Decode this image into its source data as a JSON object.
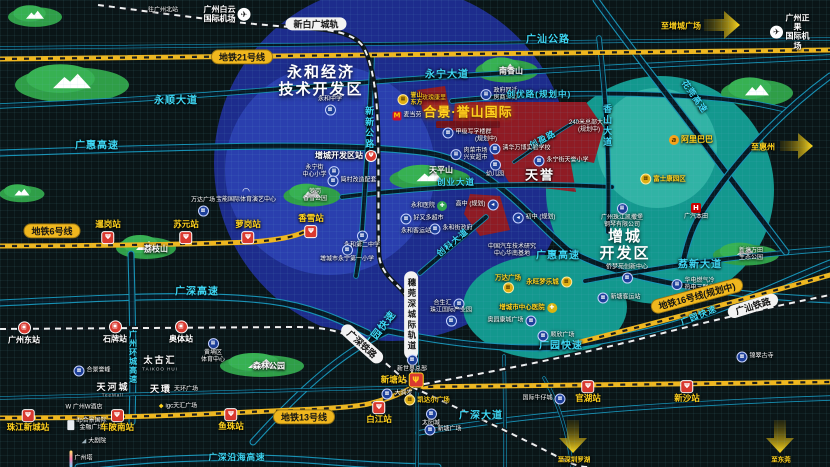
{
  "map": {
    "width": 830,
    "height": 467,
    "colors": {
      "bg": "#0a1517",
      "blue": "#1d2c8c",
      "blueInner": "#2a3fae",
      "teal": "#13988e",
      "tealInner": "#31b3a5",
      "red": "#8f1b24",
      "park": "#2f9e47",
      "gold": "#ffd21e",
      "cyan": "#3fd9f6",
      "yline": "#f0b71e"
    },
    "labels": [
      {
        "name": "to-gz-north",
        "text": "往广州北站",
        "x": 163,
        "y": 11,
        "cls": "tiny"
      },
      {
        "name": "baiyun-airport",
        "text": "广州白云\n国际机场",
        "x": 227,
        "y": 14,
        "cls": "white8",
        "ic": "plane",
        "side": "r"
      },
      {
        "name": "xinbaiguang-pill",
        "text": "新白广城轨",
        "x": 316,
        "y": 24,
        "cls": "pill-w"
      },
      {
        "name": "m21-pill",
        "text": "地铁21号线",
        "x": 242,
        "y": 57,
        "cls": "pill-y"
      },
      {
        "name": "guangshan-highway",
        "text": "广汕公路",
        "x": 548,
        "y": 40,
        "cls": "road"
      },
      {
        "name": "to-zengcheng-square",
        "text": "至增城广场",
        "x": 681,
        "y": 26,
        "cls": "gold8"
      },
      {
        "name": "zhengguo-airport",
        "text": "广州正果\n国际机场",
        "x": 790,
        "y": 32,
        "cls": "white8",
        "ic": "plane",
        "side": "l"
      },
      {
        "name": "yonghe-zone-title",
        "text": "永和经济\n技术开发区",
        "x": 321,
        "y": 81,
        "cls": "zone"
      },
      {
        "name": "yongshun-avenue",
        "text": "永顺大道",
        "x": 176,
        "y": 101,
        "cls": "road"
      },
      {
        "name": "guanghui-expressway",
        "text": "广惠高速",
        "x": 97,
        "y": 146,
        "cls": "road"
      },
      {
        "name": "yongning-avenue",
        "text": "永宁大道",
        "x": 447,
        "y": 75,
        "cls": "road"
      },
      {
        "name": "nanxiang-mountain",
        "text": "南香山",
        "x": 511,
        "y": 71,
        "cls": "poi7"
      },
      {
        "name": "yushan-dongfang",
        "text": "誉山\n东方",
        "x": 410,
        "y": 100,
        "cls": "proj-sm",
        "ic": "bldg",
        "side": "l"
      },
      {
        "name": "kangli-plot",
        "text": "玫瑰康里",
        "x": 434,
        "y": 99,
        "cls": "red-sm"
      },
      {
        "name": "govt-resettle-street",
        "text": "政府回迁\n房商业街",
        "x": 499,
        "y": 95,
        "cls": "tiny",
        "ic": "bld",
        "side": "l"
      },
      {
        "name": "chuangyou-road",
        "text": "创优路(规划中)",
        "x": 539,
        "y": 95,
        "cls": "road-sm"
      },
      {
        "name": "mcdonalds",
        "text": "麦当劳",
        "x": 407,
        "y": 116,
        "cls": "tiny",
        "ic": "mcd",
        "side": "l"
      },
      {
        "name": "yushan-international-title",
        "text": "合景·誉山国际",
        "x": 468,
        "y": 113,
        "cls": "proj"
      },
      {
        "name": "grade-a-offices",
        "text": "甲级写字楼群",
        "x": 467,
        "y": 133,
        "cls": "tiny",
        "ic": "bld",
        "side": "l"
      },
      {
        "name": "offices-planned",
        "text": "(规划中)",
        "x": 486,
        "y": 140,
        "cls": "tiny"
      },
      {
        "name": "hq-tower-240m",
        "text": "240米总部大楼\n(规划中)",
        "x": 589,
        "y": 127,
        "cls": "tiny"
      },
      {
        "name": "chuangying-road",
        "text": "创盈路",
        "x": 543,
        "y": 140,
        "cls": "road-sm",
        "rot": -28
      },
      {
        "name": "xiangshan-avenue",
        "text": "香山大道",
        "x": 607,
        "y": 126,
        "cls": "road-v"
      },
      {
        "name": "alibaba",
        "text": "阿里巴巴",
        "x": 691,
        "y": 140,
        "cls": "gold8",
        "ic": "ali",
        "side": "l"
      },
      {
        "name": "to-huizhou",
        "text": "至惠州",
        "x": 763,
        "y": 147,
        "cls": "gold8"
      },
      {
        "name": "foxconn-park",
        "text": "富士康园区",
        "x": 663,
        "y": 179,
        "cls": "gold",
        "ic": "bldg",
        "side": "l"
      },
      {
        "name": "huaguan-expressway",
        "text": "花莞高速",
        "x": 694,
        "y": 97,
        "cls": "road-sm",
        "rot": 55
      },
      {
        "name": "zengcheng-devzone-station",
        "text": "增城开发区站",
        "x": 346,
        "y": 156,
        "cls": "white8",
        "ic": "mround",
        "side": "r"
      },
      {
        "name": "yongning-central-primary",
        "text": "永宁街\n中心小学",
        "x": 321,
        "y": 172,
        "cls": "tiny",
        "ic": "bld",
        "side": "r"
      },
      {
        "name": "jiancun-renewal",
        "text": "简村改造配套",
        "x": 352,
        "y": 181,
        "cls": "tiny",
        "ic": "bld",
        "side": "l"
      },
      {
        "name": "luogang-xiangxue-park",
        "text": "萝岗\n香雪公园",
        "x": 315,
        "y": 196,
        "cls": "tiny"
      },
      {
        "name": "baoneng-arena",
        "text": "宝能国际体育演艺中心",
        "x": 246,
        "y": 196,
        "cls": "tiny",
        "ic": "dome",
        "side": "t"
      },
      {
        "name": "wanda-plaza-suyuan",
        "text": "万达广场",
        "x": 203,
        "y": 207,
        "cls": "tiny",
        "ic": "bld",
        "side": "b"
      },
      {
        "name": "tianping-mountain",
        "text": "天平山",
        "x": 441,
        "y": 170,
        "cls": "poi7"
      },
      {
        "name": "chuangye-avenue",
        "text": "创业大道",
        "x": 456,
        "y": 183,
        "cls": "road-sm"
      },
      {
        "name": "tianyu-district",
        "text": "天誉",
        "x": 540,
        "y": 176,
        "cls": "zone-sm"
      },
      {
        "name": "food-market",
        "text": "肉菜市场\n兴安超市",
        "x": 469,
        "y": 155,
        "cls": "tiny",
        "ic": "bld",
        "side": "l"
      },
      {
        "name": "qinghua-wanbo-school",
        "text": "清华万博实验学校",
        "x": 520,
        "y": 149,
        "cls": "tiny",
        "ic": "bld",
        "side": "l"
      },
      {
        "name": "kindergarten",
        "text": "幼儿园",
        "x": 495,
        "y": 169,
        "cls": "tiny",
        "ic": "bld",
        "side": "t"
      },
      {
        "name": "tianyu-primary",
        "text": "永宁街天誉小学",
        "x": 561,
        "y": 161,
        "cls": "tiny",
        "ic": "bld",
        "side": "l"
      },
      {
        "name": "m6-pill",
        "text": "地铁6号线",
        "x": 52,
        "y": 231,
        "cls": "pill-y"
      },
      {
        "name": "xiangxue-station",
        "text": "香雪站",
        "x": 311,
        "y": 226,
        "cls": "station",
        "ic": "metro",
        "side": "b"
      },
      {
        "name": "xiangang-station",
        "text": "暹岗站",
        "x": 108,
        "y": 232,
        "cls": "station",
        "ic": "metro",
        "side": "b"
      },
      {
        "name": "suyuan-station",
        "text": "苏元站",
        "x": 186,
        "y": 232,
        "cls": "station",
        "ic": "metro",
        "side": "b"
      },
      {
        "name": "luogang-station",
        "text": "萝岗站",
        "x": 248,
        "y": 232,
        "cls": "station",
        "ic": "metro",
        "side": "b"
      },
      {
        "name": "lizhi-mountain",
        "text": "荔枝山",
        "x": 156,
        "y": 249,
        "cls": "poi7"
      },
      {
        "name": "yonghe-hospital",
        "text": "永和医院",
        "x": 429,
        "y": 206,
        "cls": "tiny",
        "ic": "cross",
        "side": "r"
      },
      {
        "name": "highschool-planned",
        "text": "高中 (规划)",
        "x": 477,
        "y": 205,
        "cls": "tiny",
        "ic": "arrowb",
        "side": "r"
      },
      {
        "name": "middleschool-planned",
        "text": "初中 (规划)",
        "x": 534,
        "y": 218,
        "cls": "tiny",
        "ic": "arrowb",
        "side": "l"
      },
      {
        "name": "yonghe-govt",
        "text": "永和街政府",
        "x": 451,
        "y": 229,
        "cls": "tiny",
        "ic": "bld",
        "side": "l"
      },
      {
        "name": "trust-mart",
        "text": "好又多超市",
        "x": 422,
        "y": 219,
        "cls": "tiny",
        "ic": "bld",
        "side": "l"
      },
      {
        "name": "yonghe-bus-terminal",
        "text": "永和客运站",
        "x": 416,
        "y": 232,
        "cls": "tiny"
      },
      {
        "name": "yonghe-no2-middle",
        "text": "永和第二中学",
        "x": 362,
        "y": 240,
        "cls": "tiny",
        "ic": "bld",
        "side": "t"
      },
      {
        "name": "yongning-no1-primary",
        "text": "增城市永宁第一小学",
        "x": 347,
        "y": 254,
        "cls": "tiny",
        "ic": "bld",
        "side": "t"
      },
      {
        "name": "catarc-south-base",
        "text": "中国汽车技术研究\n中心华南基地",
        "x": 512,
        "y": 251,
        "cls": "tiny"
      },
      {
        "name": "chuangke-avenue",
        "text": "创科大道",
        "x": 453,
        "y": 243,
        "cls": "road-sm",
        "rot": -40
      },
      {
        "name": "guanghui-expressway-2",
        "text": "广惠高速",
        "x": 558,
        "y": 256,
        "cls": "road"
      },
      {
        "name": "zengcheng-zone-title",
        "text": "增城\n开发区",
        "x": 625,
        "y": 245,
        "cls": "zone"
      },
      {
        "name": "kayserburg-piano",
        "text": "广州珠江凯撒堡\n钢琴有限公司",
        "x": 622,
        "y": 216,
        "cls": "tiny",
        "ic": "bld",
        "side": "t"
      },
      {
        "name": "gac-honda",
        "text": "广汽本田",
        "x": 696,
        "y": 212,
        "cls": "tiny",
        "ic": "honda",
        "side": "t"
      },
      {
        "name": "lixin-avenue",
        "text": "荔新大道",
        "x": 700,
        "y": 265,
        "cls": "road"
      },
      {
        "name": "wantian-eco-park",
        "text": "新塘万田\n生态公园",
        "x": 751,
        "y": 255,
        "cls": "tiny"
      },
      {
        "name": "qiaomengyuan-center",
        "text": "侨梦苑创新中心",
        "x": 627,
        "y": 274,
        "cls": "tiny",
        "ic": "bld",
        "side": "b"
      },
      {
        "name": "xintang-bus-terminal",
        "text": "新塘客运站",
        "x": 619,
        "y": 298,
        "cls": "tiny",
        "ic": "bld",
        "side": "l"
      },
      {
        "name": "huadian-energy",
        "text": "华电燃气冷\n热电三联供",
        "x": 693,
        "y": 285,
        "cls": "tiny",
        "ic": "bld",
        "side": "l"
      },
      {
        "name": "m16-pill",
        "text": "地铁16号线(规划中)",
        "x": 697,
        "y": 296,
        "cls": "pill-y",
        "rot": -15
      },
      {
        "name": "guangyuan-expwy-1",
        "text": "广园快速",
        "x": 381,
        "y": 330,
        "cls": "road",
        "rot": -52
      },
      {
        "name": "guangyuan-expwy-2",
        "text": "广园快速",
        "x": 561,
        "y": 346,
        "cls": "road"
      },
      {
        "name": "guangyuan-expwy-3",
        "text": "广园快速",
        "x": 699,
        "y": 316,
        "cls": "road-sm",
        "rot": -22
      },
      {
        "name": "guangshan-railway-pill",
        "text": "广汕铁路",
        "x": 753,
        "y": 306,
        "cls": "pill-w",
        "rot": -17
      },
      {
        "name": "ancient-temple",
        "text": "锦翠古寺",
        "x": 755,
        "y": 357,
        "cls": "tiny",
        "ic": "bld",
        "side": "l"
      },
      {
        "name": "guangshen-railway-pill",
        "text": "广深铁路",
        "x": 362,
        "y": 344,
        "cls": "pill-w",
        "rot": 42
      },
      {
        "name": "suiguanshen-pill",
        "text": "穗莞深城际轨道",
        "x": 411,
        "y": 315,
        "cls": "pill-wv"
      },
      {
        "name": "new-world-hq",
        "text": "新世界总部",
        "x": 412,
        "y": 364,
        "cls": "tiny",
        "ic": "bld",
        "side": "t"
      },
      {
        "name": "hopson-one",
        "text": "合生汇",
        "x": 449,
        "y": 304,
        "cls": "tiny",
        "ic": "bld",
        "side": "r"
      },
      {
        "name": "zhujiang-industrial-park",
        "text": "珠江国际产业园",
        "x": 451,
        "y": 317,
        "cls": "tiny",
        "ic": "bld",
        "side": "b"
      },
      {
        "name": "wanda-plaza-planned",
        "text": "万达广场",
        "x": 508,
        "y": 284,
        "cls": "gold",
        "ic": "bldg",
        "side": "b"
      },
      {
        "name": "aeon-mall",
        "text": "永旺梦乐城",
        "x": 549,
        "y": 282,
        "cls": "gold",
        "ic": "bldg",
        "side": "r"
      },
      {
        "name": "zc-central-hospital",
        "text": "增城市中心医院",
        "x": 528,
        "y": 308,
        "cls": "gold",
        "ic": "crossg",
        "side": "r"
      },
      {
        "name": "aoyuan-kangcheng-plaza",
        "text": "奥园康城广场",
        "x": 512,
        "y": 321,
        "cls": "tiny",
        "ic": "bld",
        "side": "r"
      },
      {
        "name": "shunxin-plaza",
        "text": "顺欣广场",
        "x": 556,
        "y": 336,
        "cls": "tiny",
        "ic": "bld",
        "side": "l"
      },
      {
        "name": "guangshen-expressway",
        "text": "广深高速",
        "x": 197,
        "y": 292,
        "cls": "road"
      },
      {
        "name": "ring-expressway",
        "text": "广州环城高速",
        "x": 133,
        "y": 357,
        "cls": "road-v8"
      },
      {
        "name": "gz-east-station",
        "text": "广州东站",
        "x": 24,
        "y": 333,
        "cls": "white8",
        "ic": "rail",
        "side": "t"
      },
      {
        "name": "shipai-station",
        "text": "石牌站",
        "x": 115,
        "y": 332,
        "cls": "white8",
        "ic": "rail",
        "side": "t"
      },
      {
        "name": "aoti-station",
        "text": "奥体站",
        "x": 181,
        "y": 332,
        "cls": "white8",
        "ic": "rail",
        "side": "t"
      },
      {
        "name": "huangpu-sports-center",
        "text": "黄埔区\n体育中心",
        "x": 213,
        "y": 351,
        "cls": "tiny",
        "ic": "bld",
        "side": "t"
      },
      {
        "name": "kwg-yufeng",
        "text": "合景誉峰",
        "x": 92,
        "y": 371,
        "cls": "tiny",
        "ic": "bld",
        "side": "l"
      },
      {
        "name": "taikoo-hui",
        "text": "太古汇",
        "x": 160,
        "y": 360,
        "cls": "logo"
      },
      {
        "name": "taikoo-hui-sub",
        "text": "TAIKOO HUI",
        "x": 160,
        "y": 369,
        "cls": "logo-sub"
      },
      {
        "name": "forest-park",
        "text": "森林公园",
        "x": 269,
        "y": 366,
        "cls": "poi7"
      },
      {
        "name": "teemall",
        "text": "天河城",
        "x": 113,
        "y": 387,
        "cls": "logo"
      },
      {
        "name": "teemall-sub",
        "text": "TeeMall",
        "x": 113,
        "y": 395,
        "cls": "logo-sub"
      },
      {
        "name": "parc-central",
        "text": "天環",
        "x": 161,
        "y": 389,
        "cls": "logo"
      },
      {
        "name": "parc-central-plaza",
        "text": "天环广场",
        "x": 186,
        "y": 390,
        "cls": "tiny"
      },
      {
        "name": "w-hotel",
        "text": "W 广州W酒店",
        "x": 84,
        "y": 408,
        "cls": "tiny"
      },
      {
        "name": "igc-tianhui",
        "text": "igc天汇广场",
        "x": 178,
        "y": 407,
        "cls": "tiny",
        "ic": "igc",
        "side": "l"
      },
      {
        "name": "ifp-kwg-finance",
        "text": "ifp合景国际\n金融广场",
        "x": 87,
        "y": 425,
        "cls": "tiny",
        "ic": "bldg2",
        "side": "l"
      },
      {
        "name": "opera-house",
        "text": "大剧院",
        "x": 94,
        "y": 442,
        "cls": "tiny",
        "ic": "opera",
        "side": "l"
      },
      {
        "name": "canton-tower",
        "text": "广州塔",
        "x": 81,
        "y": 459,
        "cls": "tiny",
        "ic": "tower",
        "side": "l"
      },
      {
        "name": "zhujiang-newtown-station",
        "text": "珠江新城站",
        "x": 28,
        "y": 421,
        "cls": "station",
        "ic": "metro",
        "side": "t"
      },
      {
        "name": "chebei-south-station",
        "text": "车陂南站",
        "x": 117,
        "y": 421,
        "cls": "station",
        "ic": "metro",
        "side": "t"
      },
      {
        "name": "yuzhu-station",
        "text": "鱼珠站",
        "x": 231,
        "y": 420,
        "cls": "station",
        "ic": "metro",
        "side": "t"
      },
      {
        "name": "m13-pill",
        "text": "地铁13号线",
        "x": 304,
        "y": 417,
        "cls": "pill-y"
      },
      {
        "name": "baijiang-station",
        "text": "白江站",
        "x": 379,
        "y": 413,
        "cls": "station",
        "ic": "metro",
        "side": "t"
      },
      {
        "name": "xintang-station",
        "text": "新塘站",
        "x": 402,
        "y": 380,
        "cls": "station",
        "ic": "metrobig",
        "side": "r"
      },
      {
        "name": "rt-mart",
        "text": "大润发",
        "x": 397,
        "y": 394,
        "cls": "tiny",
        "ic": "bld",
        "side": "l"
      },
      {
        "name": "kaidaer-plaza",
        "text": "凯达尔广场",
        "x": 427,
        "y": 400,
        "cls": "gold",
        "ic": "bldg",
        "side": "l"
      },
      {
        "name": "sun-city",
        "text": "太阳城",
        "x": 431,
        "y": 418,
        "cls": "tiny",
        "ic": "bld",
        "side": "t"
      },
      {
        "name": "xintang-plaza",
        "text": "新塘广场",
        "x": 443,
        "y": 430,
        "cls": "tiny",
        "ic": "bld",
        "side": "l"
      },
      {
        "name": "intl-jeans-city",
        "text": "国际牛仔城",
        "x": 544,
        "y": 399,
        "cls": "tiny",
        "ic": "bld",
        "side": "r"
      },
      {
        "name": "guanhu-station",
        "text": "官湖站",
        "x": 588,
        "y": 392,
        "cls": "station",
        "ic": "metro",
        "side": "t"
      },
      {
        "name": "xinsha-station",
        "text": "新沙站",
        "x": 687,
        "y": 392,
        "cls": "station",
        "ic": "metro",
        "side": "t"
      },
      {
        "name": "guangshen-avenue",
        "text": "广深大道",
        "x": 481,
        "y": 416,
        "cls": "road"
      },
      {
        "name": "yanhai-expressway",
        "text": "广深沿海高速",
        "x": 237,
        "y": 458,
        "cls": "road-sm"
      },
      {
        "name": "to-shenzhen-luohu",
        "text": "至深圳罗湖",
        "x": 574,
        "y": 460,
        "cls": "gold"
      },
      {
        "name": "to-dongguan",
        "text": "至东莞",
        "x": 781,
        "y": 460,
        "cls": "gold"
      },
      {
        "name": "xinxin-road",
        "text": "新新公路",
        "x": 369,
        "y": 128,
        "cls": "road-v"
      },
      {
        "name": "yonghe-middle-school",
        "text": "永和中学",
        "x": 330,
        "y": 106,
        "cls": "tiny",
        "ic": "bld",
        "side": "b"
      }
    ]
  }
}
